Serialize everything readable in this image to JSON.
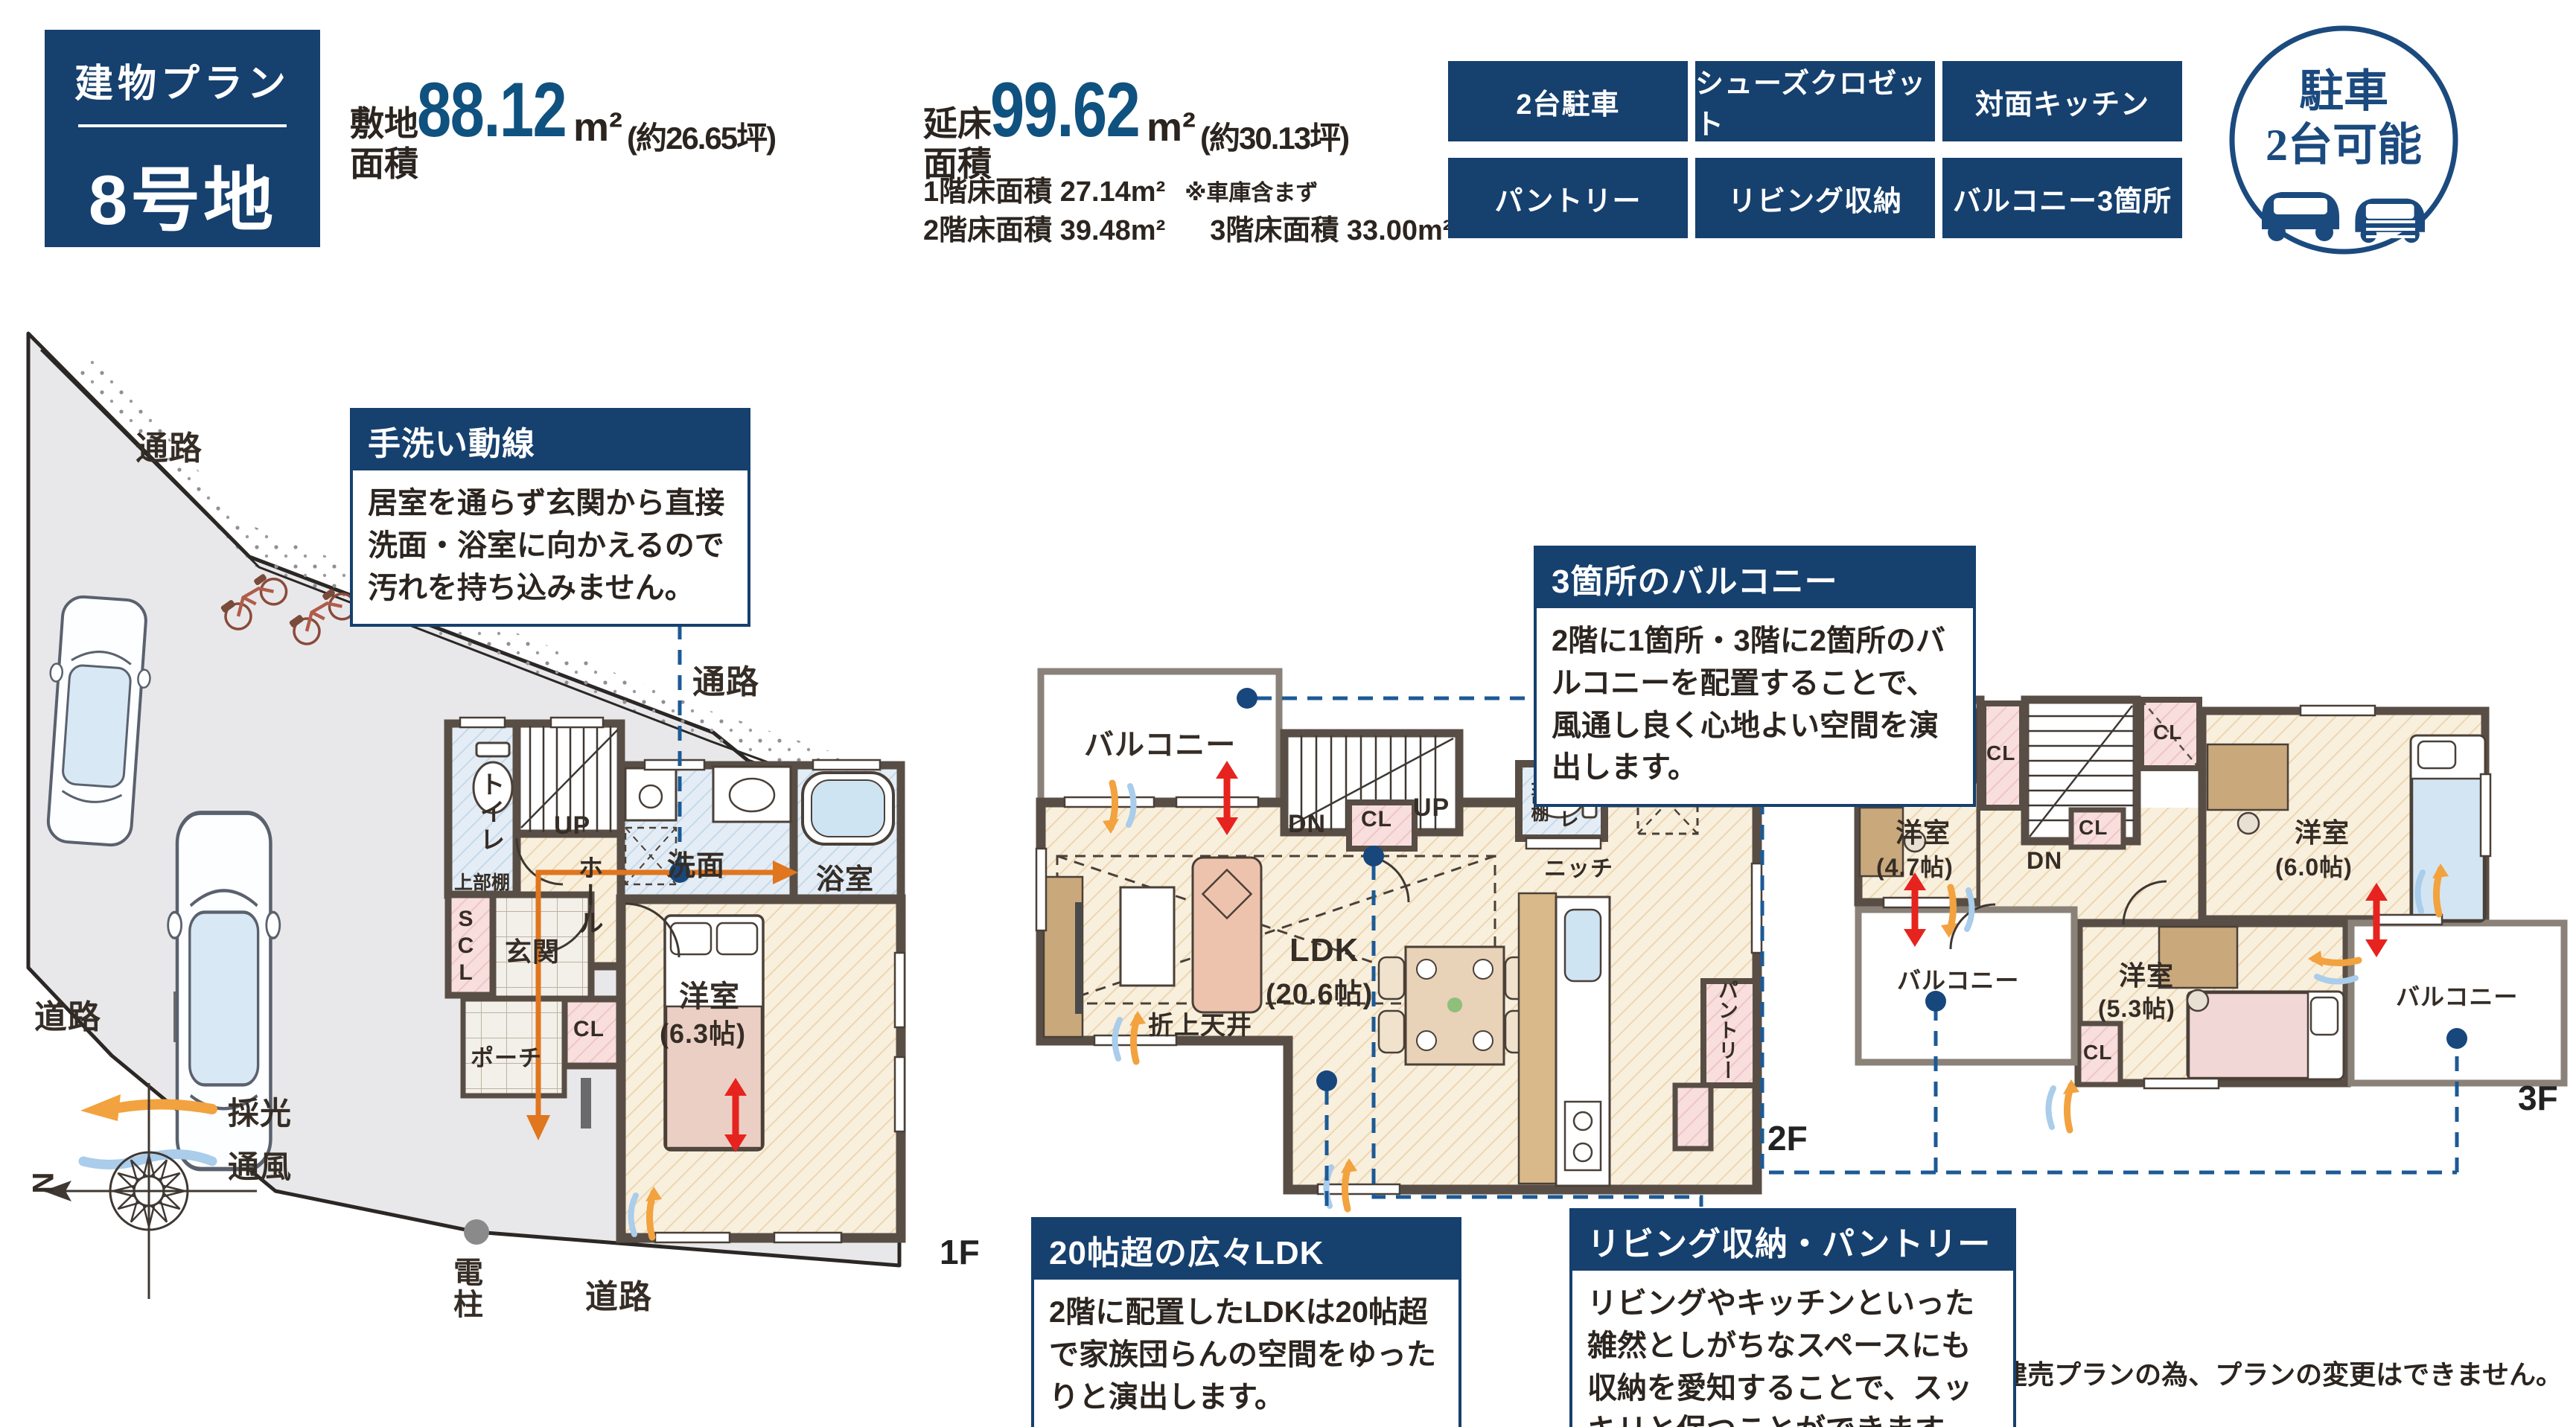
{
  "colors": {
    "navy": "#16406e",
    "number_blue": "#0f517f",
    "text_dark": "#2b241f",
    "leader_blue": "#1c5a96",
    "accent_red": "#e6231e",
    "accent_orange": "#f2a23e",
    "accent_airblue": "#a9cdea",
    "site_gray": "#e8e8ea",
    "wall_brown": "#584e45"
  },
  "header": {
    "plan_box": {
      "title": "建物プラン",
      "lot": "8号地"
    },
    "site_area": {
      "label1": "敷地",
      "label2": "面積",
      "value": "88.12",
      "unit": "m²",
      "tsubo": "(約26.65坪)"
    },
    "floor_area": {
      "label1": "延床",
      "label2": "面積",
      "value": "99.62",
      "unit": "m²",
      "tsubo": "(約30.13坪)",
      "f1": "1階床面積 27.14m²",
      "f1_note": "※車庫含まず",
      "f2": "2階床面積 39.48m²",
      "f3": "3階床面積 33.00m²"
    },
    "tags": [
      "2台駐車",
      "シューズクロゼット",
      "対面キッチン",
      "パントリー",
      "リビング収納",
      "バルコニー3箇所"
    ],
    "badge": {
      "line1": "駐車",
      "line2": "2台可能"
    }
  },
  "callouts": {
    "hand_wash": {
      "title": "手洗い動線",
      "body": "居室を通らず玄関から直接洗面・浴室に向かえるので汚れを持ち込みません。"
    },
    "balconies": {
      "title": "3箇所のバルコニー",
      "body": "2階に1箇所・3階に2箇所のバルコニーを配置することで、風通し良く心地よい空間を演出します。"
    },
    "ldk": {
      "title": "20帖超の広々LDK",
      "body": "2階に配置したLDKは20帖超で家族団らんの空間をゆったりと演出します。"
    },
    "storage": {
      "title": "リビング収納・パントリー",
      "body": "リビングやキッチンといった雑然としがちなスペースにも収納を愛知することで、スッキリと保つことができます。"
    }
  },
  "plan1f": {
    "floor_label": "1F",
    "site": {
      "passage": "通路",
      "road": "道路",
      "pole": "電柱"
    },
    "rooms": {
      "toilet": "トイレ",
      "shelf": "上部棚",
      "up": "UP",
      "wash": "洗面",
      "bath": "浴室",
      "hall": "ホール",
      "scl": "SCL",
      "entrance": "玄関",
      "cl": "CL",
      "porch": "ポーチ",
      "bedroom": "洋室",
      "bedroom_size": "(6.3帖)"
    }
  },
  "plan2f": {
    "floor_label": "2F",
    "rooms": {
      "balcony": "バルコニー",
      "dn": "DN",
      "up": "UP",
      "cl": "CL",
      "shelf": "上部棚",
      "toilet": "トイレ",
      "niche": "ニッチ",
      "ldk": "LDK",
      "ldk_size": "(20.6帖)",
      "ceiling": "折上天井",
      "pantry": "パントリー"
    }
  },
  "plan3f": {
    "floor_label": "3F",
    "rooms": {
      "bedroom1": "洋室",
      "bedroom1_size": "(4.7帖)",
      "bedroom2": "洋室",
      "bedroom2_size": "(6.0帖)",
      "bedroom3": "洋室",
      "bedroom3_size": "(5.3帖)",
      "cl": "CL",
      "dn": "DN",
      "balcony": "バルコニー"
    }
  },
  "legend": {
    "light": "採光",
    "wind": "通風",
    "north": "N"
  },
  "disclaimer": "※建売プランの為、プランの変更はできません。"
}
